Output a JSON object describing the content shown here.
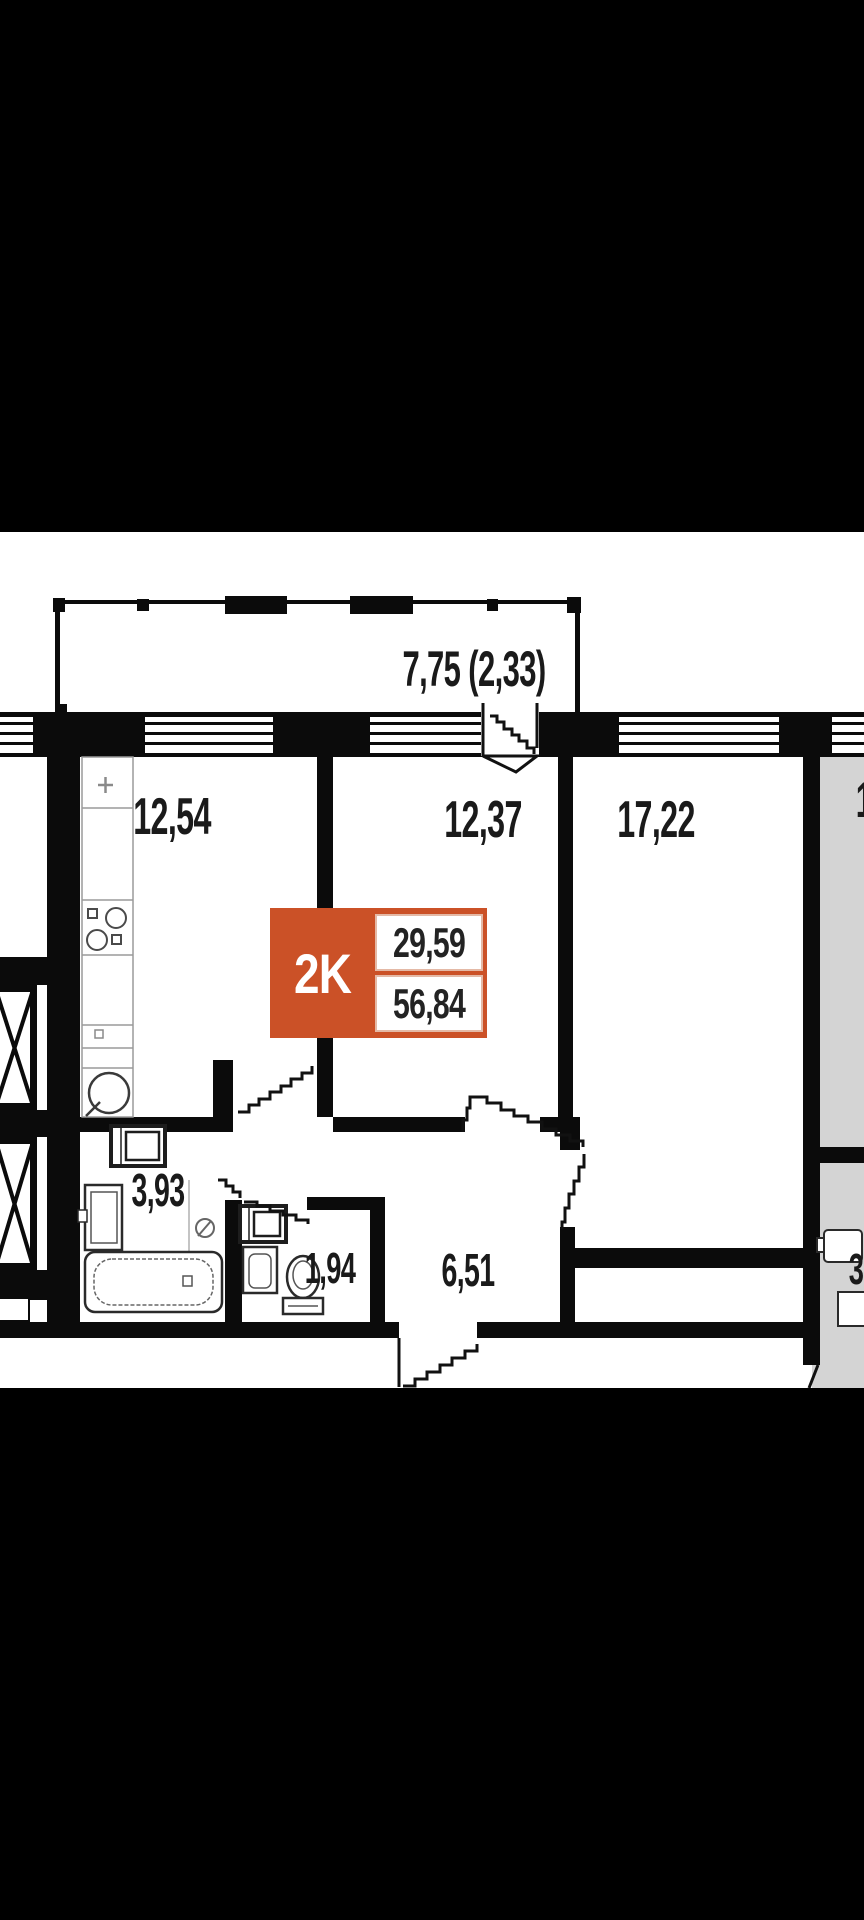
{
  "plan": {
    "balcony_label": "7,75 (2,33)",
    "rooms": {
      "kitchen": "12,54",
      "bedroom": "12,37",
      "living_room": "17,22",
      "bathroom": "3,93",
      "toilet": "1,94",
      "hallway": "6,51"
    },
    "unit_badge": {
      "type_label": "2K",
      "living_area": "29,59",
      "total_area": "56,84",
      "accent_color": "#cb5127"
    },
    "neighbor": {
      "area_label_partial": "3",
      "room_label_partial": "1"
    }
  }
}
